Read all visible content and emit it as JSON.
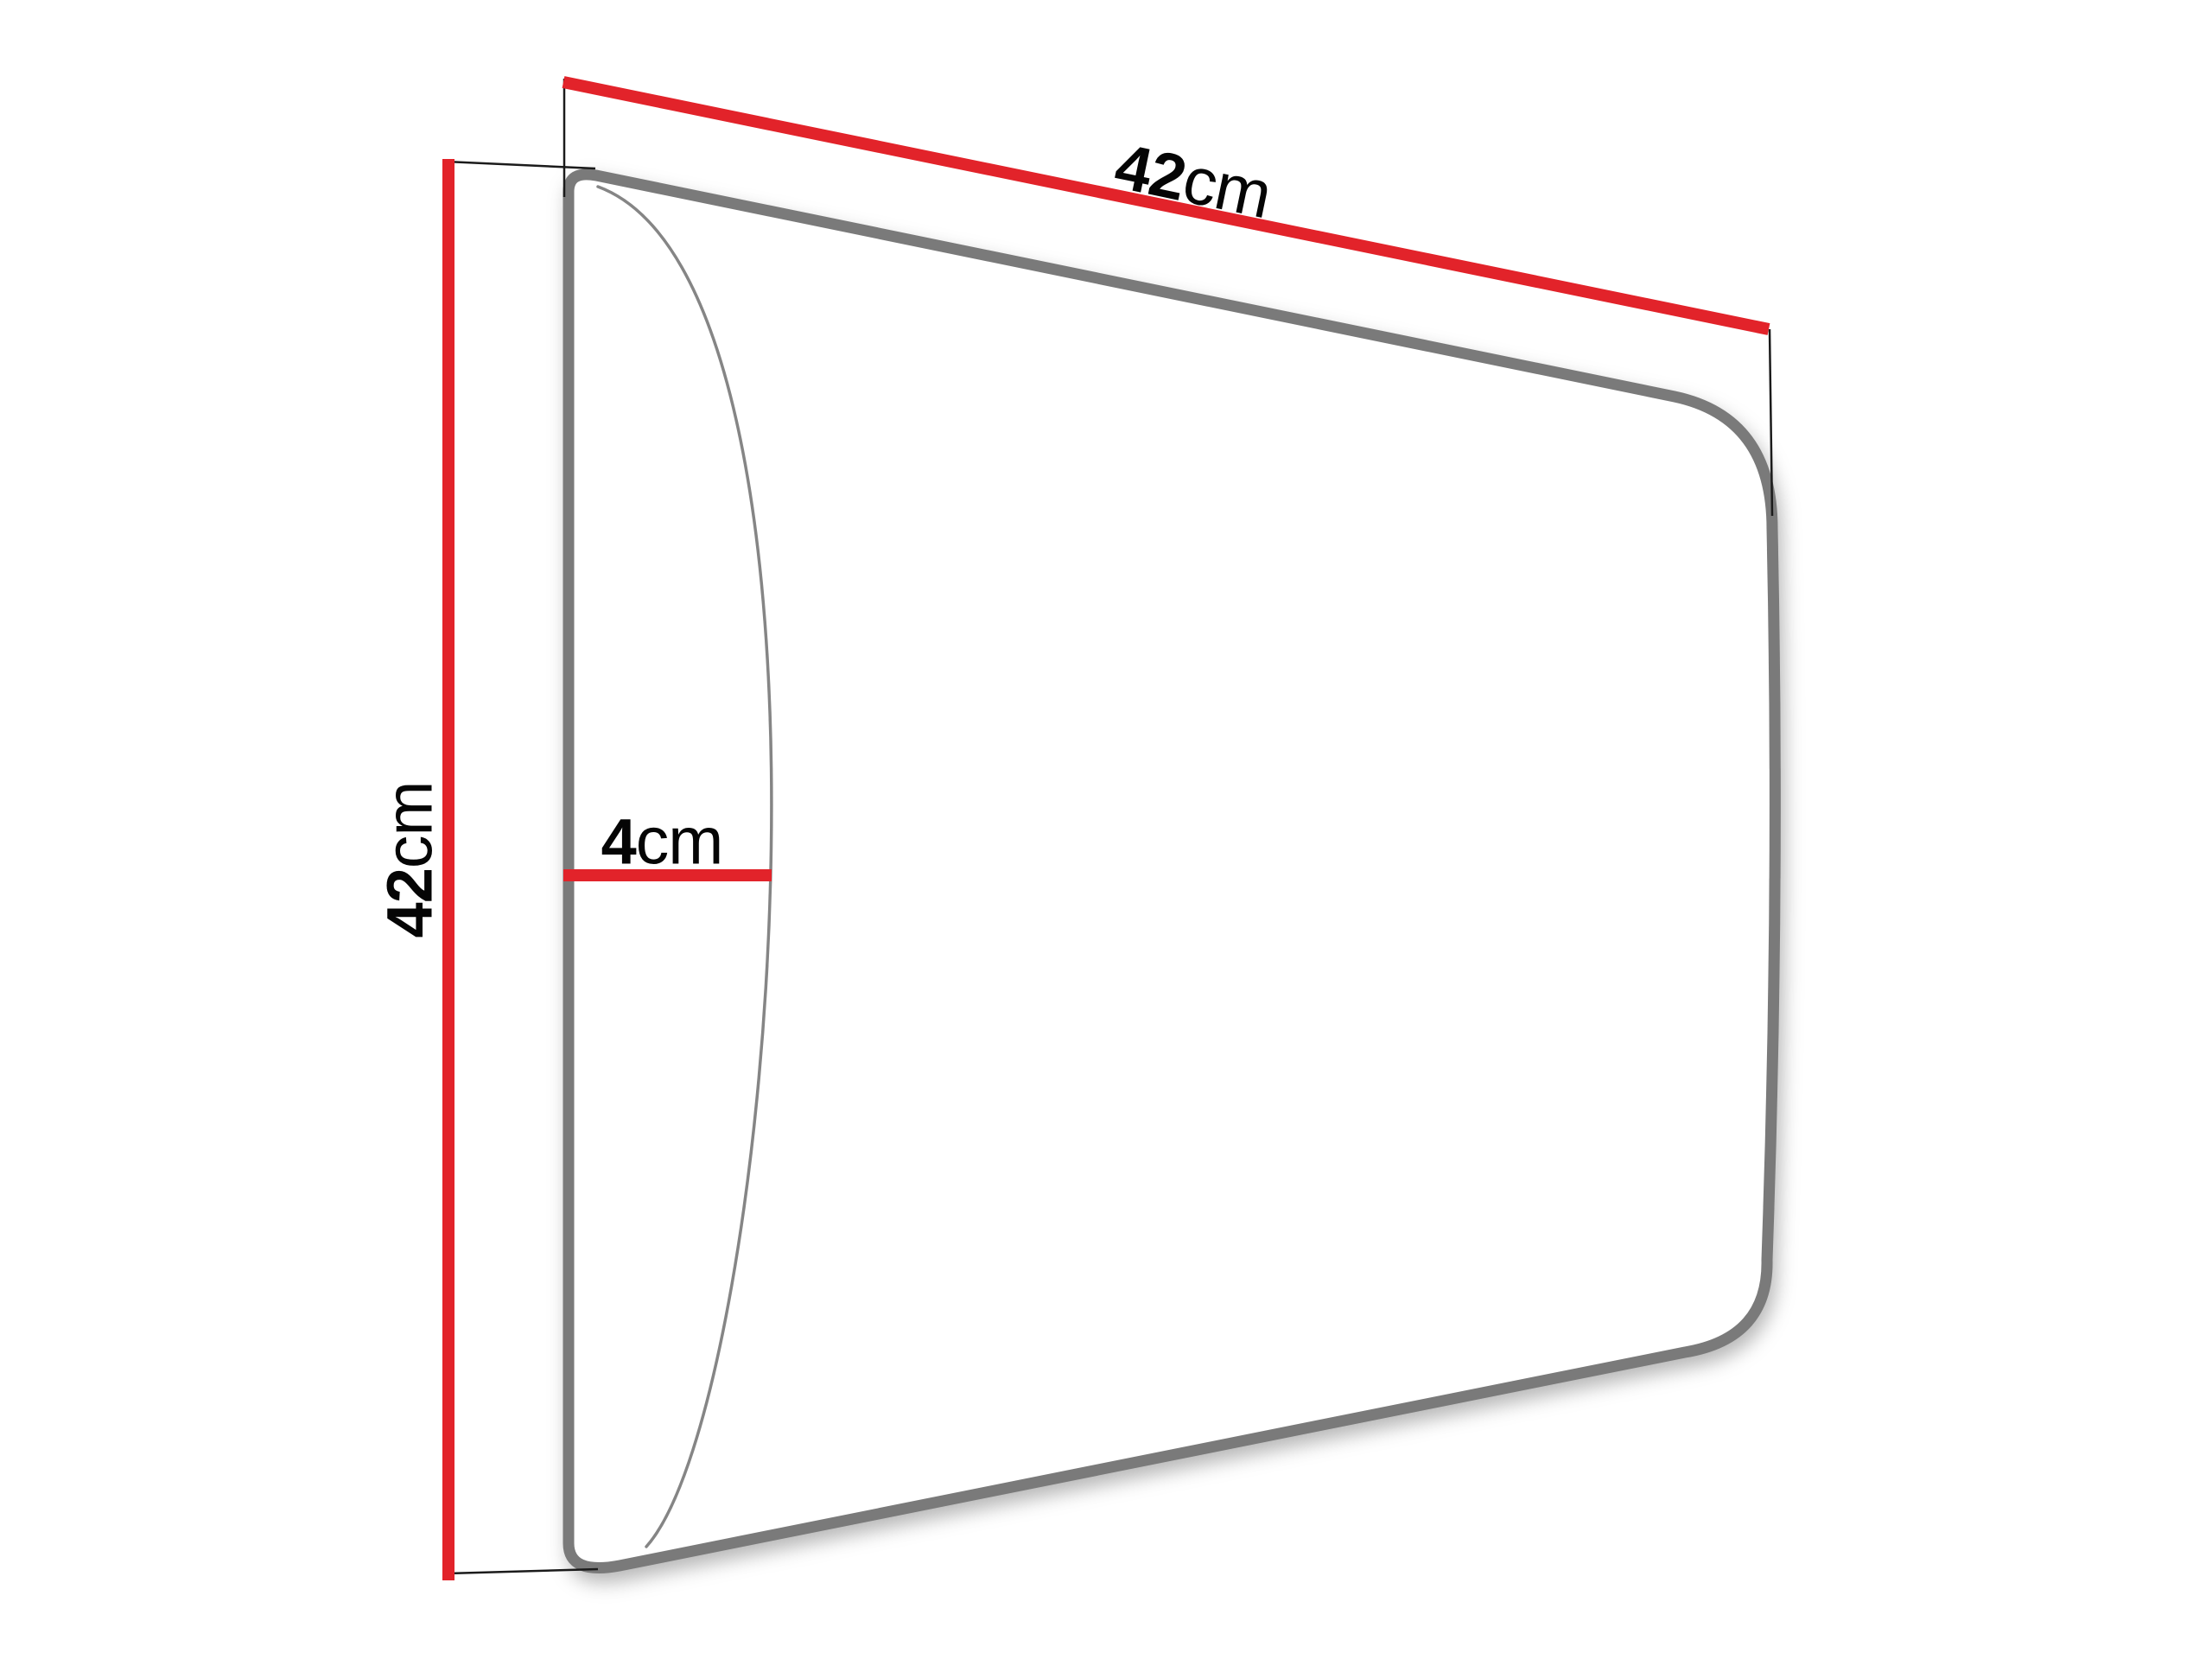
{
  "diagram": {
    "kind": "product-dimension-diagram",
    "colors": {
      "background": "#ffffff",
      "dimension_red": "#e2232a",
      "outline_gray": "#7a7a7a",
      "front_edge_gray": "#858585",
      "extension_line": "#1b1b1b",
      "text": "#050505"
    },
    "labels": {
      "width": {
        "value": "42",
        "unit": "cm"
      },
      "height": {
        "value": "42",
        "unit": "cm"
      },
      "depth": {
        "value": "4",
        "unit": "cm"
      }
    }
  }
}
